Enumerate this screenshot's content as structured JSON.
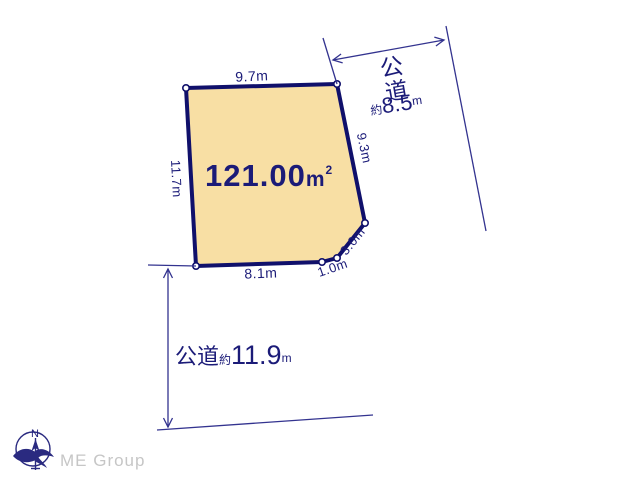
{
  "diagram": {
    "area": {
      "value": "121.00",
      "unit": "m",
      "sup": "2"
    },
    "edges": {
      "top": "9.7m",
      "left": "11.7m",
      "right": "9.3m",
      "corner": "3.0m",
      "notch": "1.0m",
      "bottom": "8.1m"
    },
    "road_right": {
      "kanji_1": "公",
      "kanji_2": "道",
      "approx": "約",
      "width": "8.5",
      "unit": "m"
    },
    "road_bottom": {
      "name": "公道",
      "approx": "約",
      "width": "11.9",
      "unit": "m"
    },
    "compass": {
      "label": "N"
    },
    "logo": {
      "text": "ME Group"
    },
    "colors": {
      "parcel_fill": "#F8DFA4",
      "parcel_stroke": "#10106B",
      "line": "#33338F",
      "text": "#1B1B78",
      "logo_gray": "#C6C6C6"
    }
  }
}
